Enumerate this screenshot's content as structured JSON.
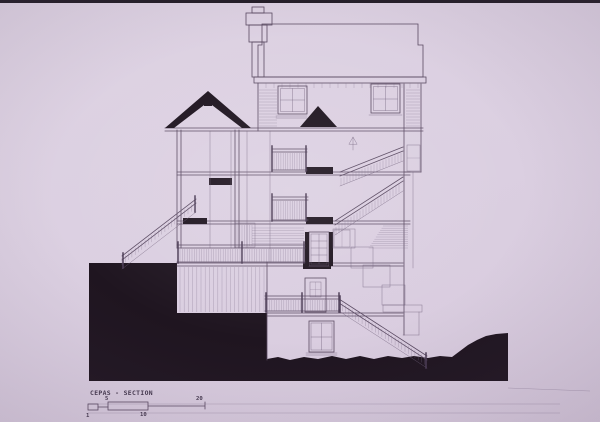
{
  "photo": {
    "colors": {
      "slide_background": "#ddd0e0",
      "ink": "#5a4a62",
      "poche_black": "#1f1520",
      "top_edge_strip": "#231d27"
    }
  },
  "titleblock": {
    "title": "CEPAS - SECTION",
    "scale_labels": [
      "1",
      "5",
      "10",
      "20"
    ]
  }
}
